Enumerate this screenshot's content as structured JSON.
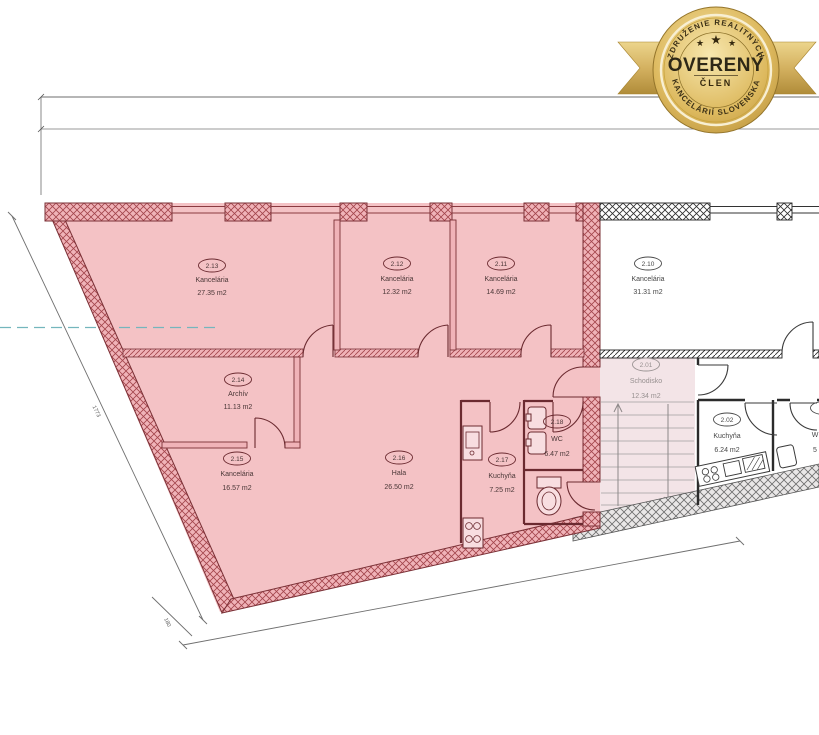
{
  "badge": {
    "top_arc": "ZDRUŽENIE REALITNÝCH",
    "bottom_arc": "KANCELÁRIÍ SLOVENSKA",
    "title": "OVERENÝ",
    "member": "ČLEN",
    "star": "★"
  },
  "plan": {
    "rooms": [
      {
        "number": "2.13",
        "name": "Kancelária",
        "area": "27.35 m2",
        "highlighted": true
      },
      {
        "number": "2.12",
        "name": "Kancelária",
        "area": "12.32 m2",
        "highlighted": true
      },
      {
        "number": "2.11",
        "name": "Kancelária",
        "area": "14.69 m2",
        "highlighted": true
      },
      {
        "number": "2.10",
        "name": "Kancelária",
        "area": "31.31 m2",
        "highlighted": false
      },
      {
        "number": "2.14",
        "name": "Archív",
        "area": "11.13 m2",
        "highlighted": true
      },
      {
        "number": "2.15",
        "name": "Kancelária",
        "area": "16.57 m2",
        "highlighted": true
      },
      {
        "number": "2.16",
        "name": "Hala",
        "area": "26.50 m2",
        "highlighted": true
      },
      {
        "number": "2.17",
        "name": "Kuchyňa",
        "area": "7.25 m2",
        "highlighted": true
      },
      {
        "number": "2.18",
        "name": "WC",
        "area": "6.47 m2",
        "highlighted": true
      },
      {
        "number": "2.01",
        "name": "Schodisko",
        "area": "12.34 m2",
        "highlighted": false
      },
      {
        "number": "2.02",
        "name": "Kuchyňa",
        "area": "6.24 m2",
        "highlighted": false
      }
    ],
    "partial_room": {
      "name_fragment": "W",
      "area_fragment": "5"
    },
    "dimensions": {
      "left": "1773",
      "left_small": "180"
    },
    "colors": {
      "highlight_pink": "#f4c2c5",
      "wall_red": "#7a3036",
      "badge_gold": "#c9a948",
      "reference_teal": "#74b6bd"
    }
  }
}
